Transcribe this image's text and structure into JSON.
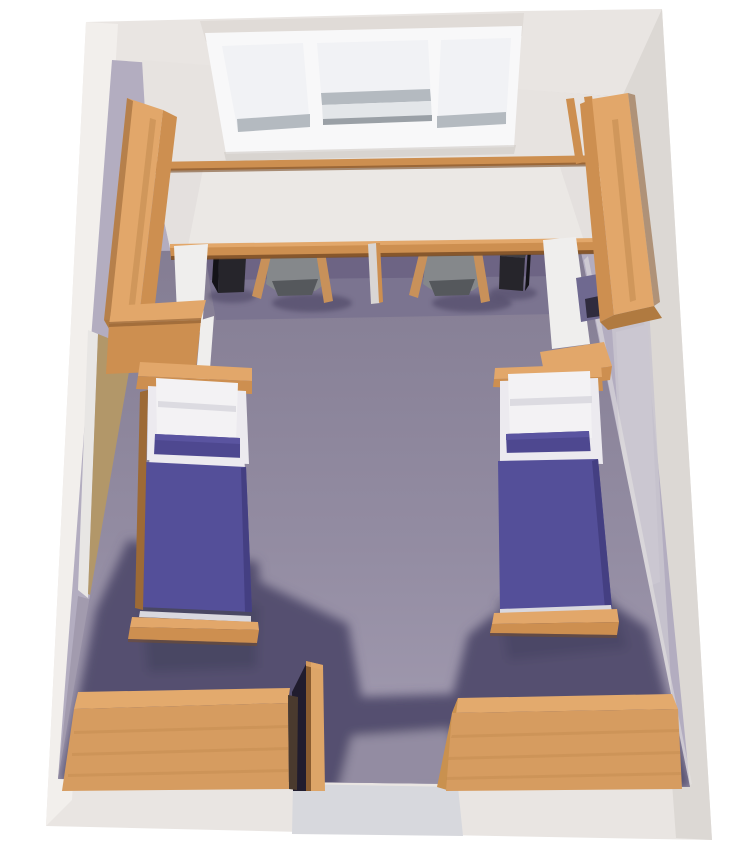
{
  "scene": {
    "kind": "3d-room-rendering",
    "objects": [
      "window",
      "wall-shelf",
      "built-in-desk",
      "desk-chair-left",
      "desk-chair-right",
      "waste-bin-left",
      "waste-bin-right",
      "desk-divider",
      "wardrobe-left",
      "wardrobe-right",
      "side-cabinet-left",
      "side-cabinet-right",
      "bed-left",
      "bed-right",
      "pillow-left",
      "pillow-right",
      "bolster-left",
      "bolster-right",
      "dresser-left",
      "dresser-right",
      "room-door-open",
      "door-left-wall",
      "door-panel-right-wall",
      "floor",
      "walls"
    ]
  },
  "colors": {
    "background": "#ffffff",
    "slab": "#e9e5e2",
    "slab_light": "#f2efec",
    "slab_dark": "#dcd8d4",
    "slab_top": "#e0dbd7",
    "slab_inset": "#d7d8dd",
    "window_frame": "#f8f8f9",
    "window_pane": "#f1f2f5",
    "window_pane_low": "#e3e6e9",
    "window_sill": "#b4bac0",
    "window_sill_dark": "#9aa0a6",
    "window_shadow": "#cfc9c4",
    "back_wall": "#e7e3e0",
    "desk_top": "#ebe8e5",
    "desk_shade": "#dfdbd8",
    "wood_light": "#e2a76a",
    "wood_mid": "#cd8f50",
    "wood_dark": "#b07a40",
    "wood_deep": "#8a5a2c",
    "wood_line": "#7a4d26",
    "rail_wood": "#9d6a36",
    "panel_white": "#efeeed",
    "divider_panel": "#d9d6d4",
    "under_desk": "#7b7490",
    "under_desk_dark": "#6b6383",
    "floor_top": "#847d93",
    "floor_mid": "#938ca2",
    "floor_bottom": "#a49db2",
    "shadow": "#555070",
    "shadow_deep": "#46415f",
    "wall_base": "#b3adc0",
    "wall_light": "#c9c5cf",
    "wall_shade": "#a29bae",
    "door_panel": "#cbc7d1",
    "door_tan": "#b29769",
    "door_tan_dark": "#8d7550",
    "trim_white": "#e8e6e4",
    "chair_gray": "#85888b",
    "chair_gray_dark": "#55585c",
    "chair_wood": "#c8915a",
    "bin_top": "#3f3e44",
    "bin_front": "#26252b",
    "bin_side": "#141318",
    "niche": "#6f6990",
    "niche_dark": "#2f2b3e",
    "mattress": "#544f99",
    "mattress_dark": "#443f82",
    "bolster": "#4e4890",
    "bolster_light": "#5a54a0",
    "pillow": "#f3f2f4",
    "pillow_fold": "#dcdbe1",
    "sheet": "#eceaef",
    "sheet_dim": "#d9d8df",
    "dresser_top": "#e3aa6d",
    "dresser_front": "#d69c60",
    "dresser_side": "#c9914f",
    "dresser_dark": "#4a3a2e",
    "gap_dark": "#201c2e",
    "door_center": "#dda568",
    "door_center_edge": "#8a5c30",
    "texture_line": "#c08a4e"
  }
}
